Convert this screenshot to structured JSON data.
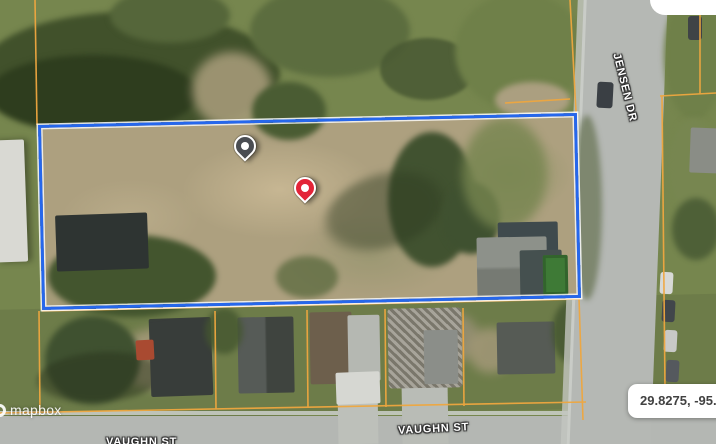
{
  "map": {
    "attribution": "mapbox",
    "street_labels": {
      "jensen_dr": "JENSEN DR",
      "vaughn_st": "VAUGHN ST"
    },
    "coordinates_badge": "29.8275, -95.343",
    "colors": {
      "boundary_blue": "#2667EC",
      "parcel_orange": "#EFA73F",
      "marker_red": "#E32438",
      "marker_dark": "#4A4D52",
      "road_gray": "#B5B8B4"
    },
    "markers": [
      {
        "id": "secondary-marker",
        "color": "#4A4D52"
      },
      {
        "id": "primary-marker",
        "color": "#E32438"
      }
    ]
  }
}
